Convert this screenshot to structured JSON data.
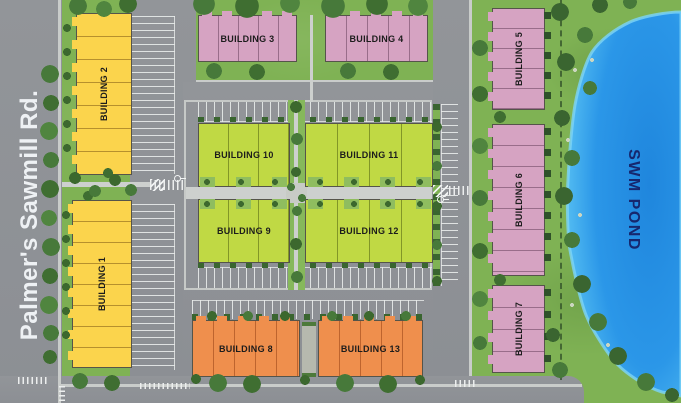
{
  "plan": {
    "road": {
      "label": "Palmer's Sawmill Rd."
    },
    "pond": {
      "label": "SWM POND"
    },
    "buildings": [
      {
        "num": 1,
        "label": "BUILDING 1",
        "color": "#fbd44c"
      },
      {
        "num": 2,
        "label": "BUILDING 2",
        "color": "#fbd44c"
      },
      {
        "num": 3,
        "label": "BUILDING 3",
        "color": "#d6a3c2"
      },
      {
        "num": 4,
        "label": "BUILDING 4",
        "color": "#d6a3c2"
      },
      {
        "num": 5,
        "label": "BUILDING 5",
        "color": "#d6a3c2"
      },
      {
        "num": 6,
        "label": "BUILDING 6",
        "color": "#d6a3c2"
      },
      {
        "num": 7,
        "label": "BUILDING 7",
        "color": "#d6a3c2"
      },
      {
        "num": 8,
        "label": "BUILDING 8",
        "color": "#ef8f4d"
      },
      {
        "num": 9,
        "label": "BUILDING 9",
        "color": "#c0d944"
      },
      {
        "num": 10,
        "label": "BUILDING 10",
        "color": "#c0d944"
      },
      {
        "num": 11,
        "label": "BUILDING 11",
        "color": "#c0d944"
      },
      {
        "num": 12,
        "label": "BUILDING 12",
        "color": "#c0d944"
      },
      {
        "num": 13,
        "label": "BUILDING 13",
        "color": "#ef8f4d"
      }
    ],
    "colors": {
      "grass": "#7fb254",
      "road": "#8f9297",
      "sidewalk": "#c9ccca",
      "stall_line": "#e8ebea",
      "tree": "#47793a",
      "pond_deep": "#1f86dd",
      "pond_shallow": "#5ec6f4",
      "pond_label_text": "#16276e",
      "road_label_text": "#eef1f4"
    }
  }
}
